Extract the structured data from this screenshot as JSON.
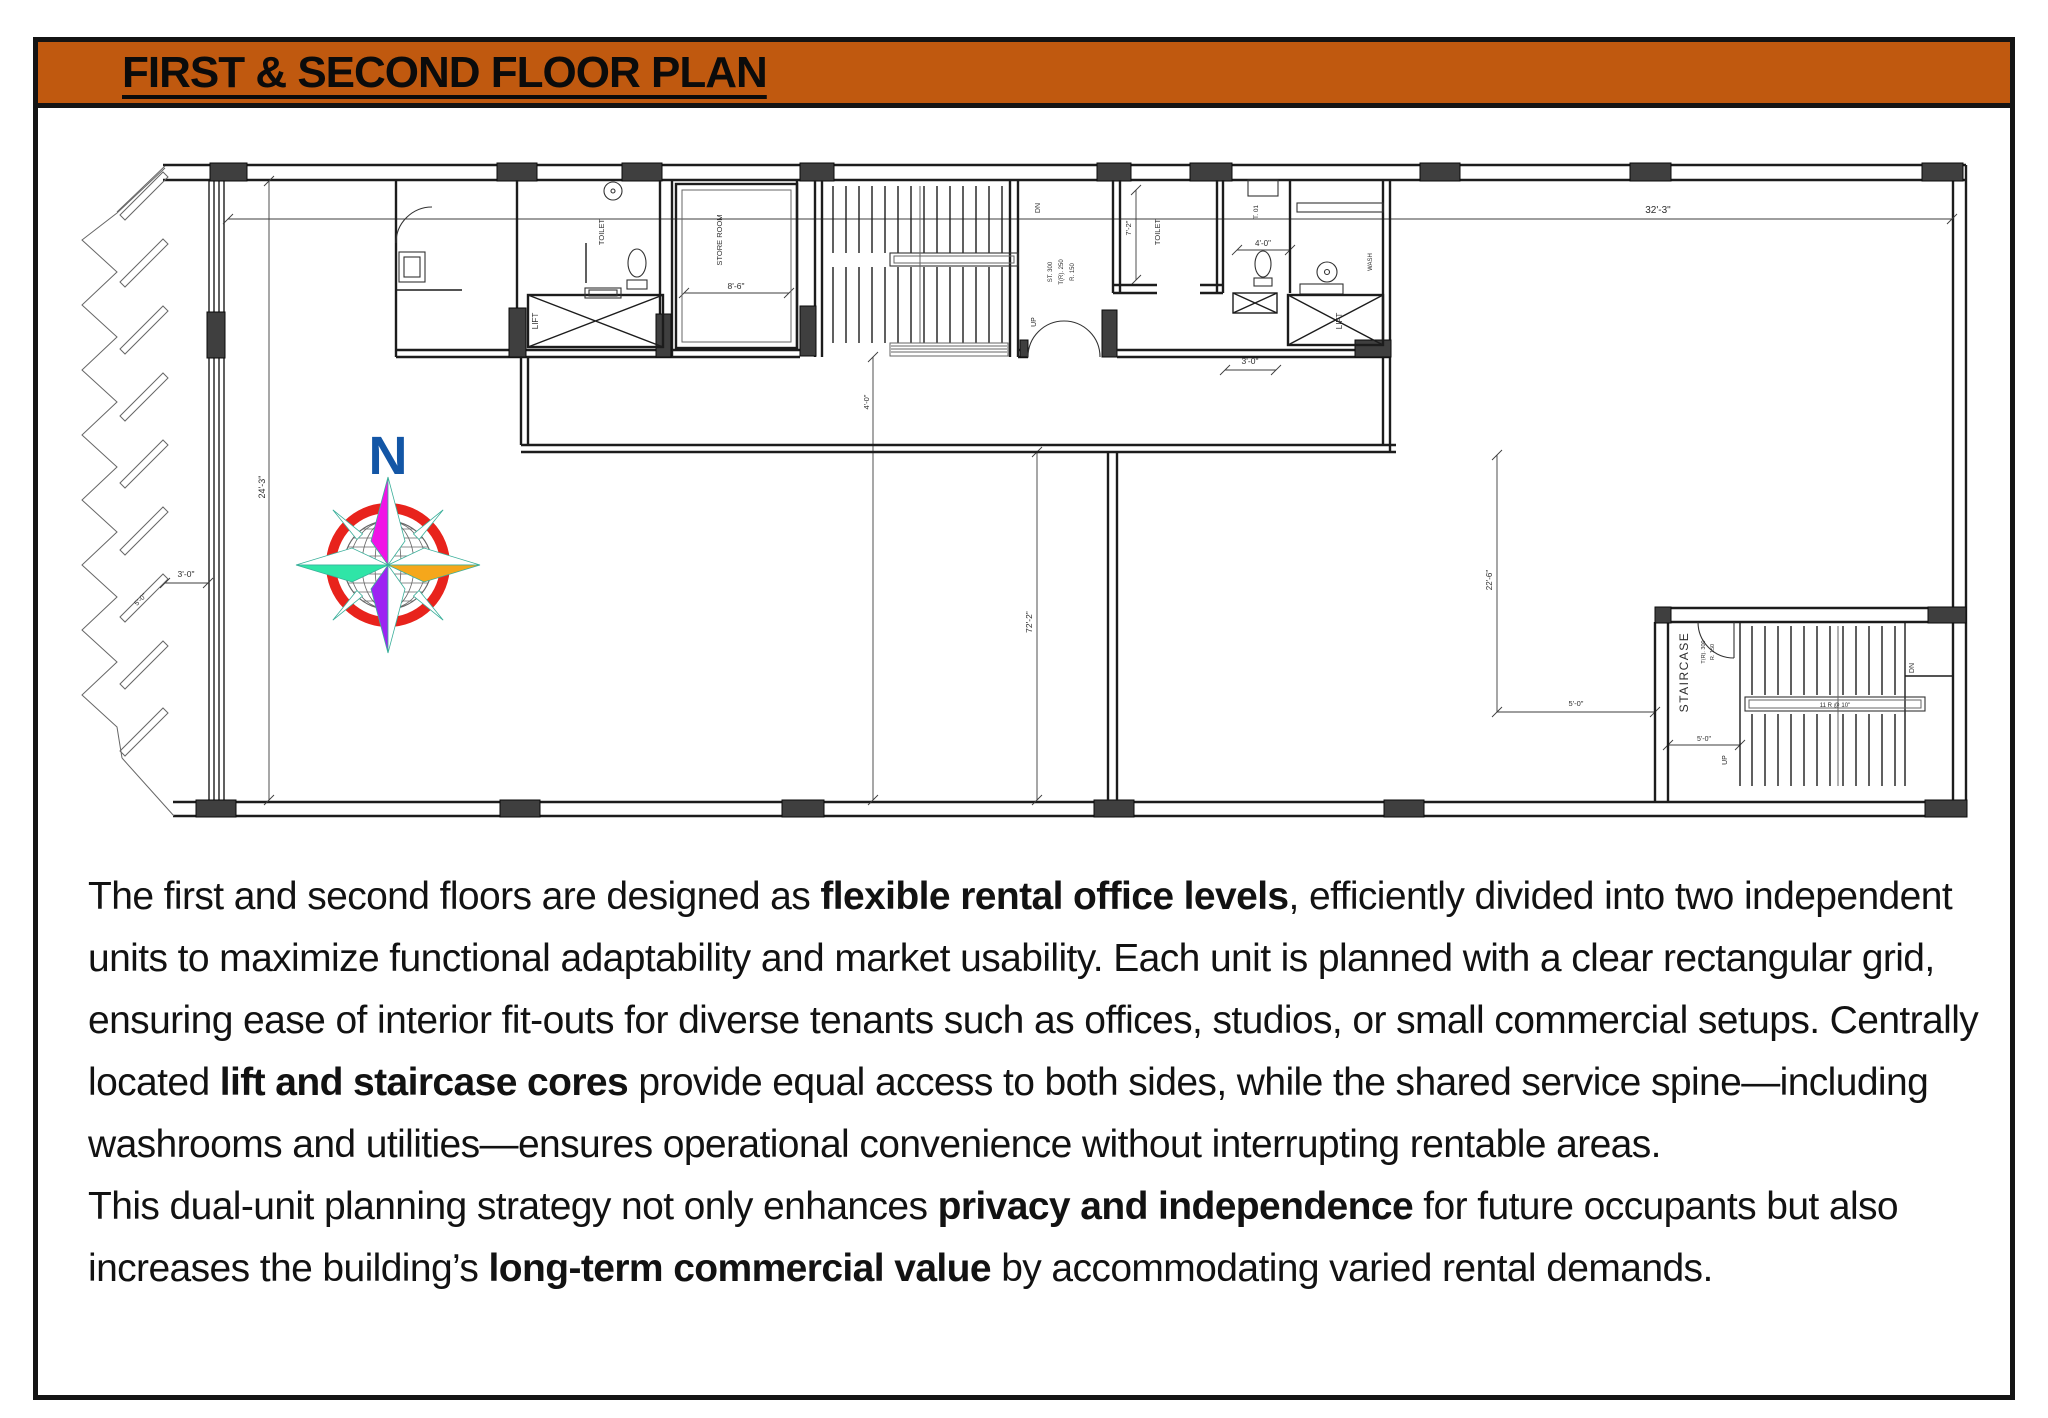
{
  "slide": {
    "title": "FIRST & SECOND FLOOR PLAN",
    "banner_color": "#C0590F",
    "border_color": "#141414"
  },
  "compass": {
    "north_label": "N",
    "letter_color": "#1356A6",
    "ring_color": "#E8231C",
    "north_color": "#F014E6",
    "east_color": "#F5A71B",
    "west_color": "#2FE5A7",
    "south_color": "#9D23F2"
  },
  "plan": {
    "labels": {
      "dim_32_3": "32'-3\"",
      "dim_24_3": "24'-3\"",
      "dim_3_0_left": "3'-0\"",
      "dim_5_0_diag": "5'-0\"",
      "dim_8_6": "8'-6\"",
      "store_room": "STORE ROOM",
      "toilet_left": "TOILET",
      "lift_left": "LIFT",
      "dn_center": "DN",
      "up_center": "UP",
      "note_st": "ST. 300",
      "note_tr": "T(R). 250",
      "note_r": "R. 150",
      "dim_4_0_v": "4'-0\"",
      "dim_72_2": "72'-2\"",
      "dim_22_6": "22'-6\"",
      "dim_5_0_a": "5'-0\"",
      "toilet_right": "TOILET",
      "dim_7_2": "7'-2\"",
      "t01": "T. 01",
      "dim_4_0": "4'-0\"",
      "wash": "WASH",
      "lift_right": "LIFT",
      "dim_3_0_right": "3'-0\"",
      "staircase": "STAIRCASE",
      "note_tr_r": "T(R). 300",
      "note_r_r": "R. 150",
      "up_right": "UP",
      "dn_right": "DN",
      "rail_note": "11 R @ 10\"",
      "dim_5_0_b": "5'-0\""
    }
  },
  "paragraph": {
    "segments": [
      {
        "t": "The first and second floors are designed as "
      },
      {
        "t": "flexible rental office levels",
        "b": true
      },
      {
        "t": ", efficiently divided into two independent units to maximize functional adaptability and market usability. Each unit is planned with a clear rectangular grid, ensuring ease of interior fit-outs for diverse tenants such as offices, studios, or small commercial setups. Centrally located "
      },
      {
        "t": "lift and staircase cores",
        "b": true
      },
      {
        "t": " provide equal access to both sides, while the shared service spine—including washrooms and utilities—ensures operational convenience without interrupting rentable areas.\n"
      },
      {
        "t": "This dual-unit planning strategy not only enhances "
      },
      {
        "t": "privacy and independence",
        "b": true
      },
      {
        "t": " for future occupants but also increases the building’s "
      },
      {
        "t": "long-term commercial value",
        "b": true
      },
      {
        "t": " by accommodating varied rental demands."
      }
    ]
  }
}
